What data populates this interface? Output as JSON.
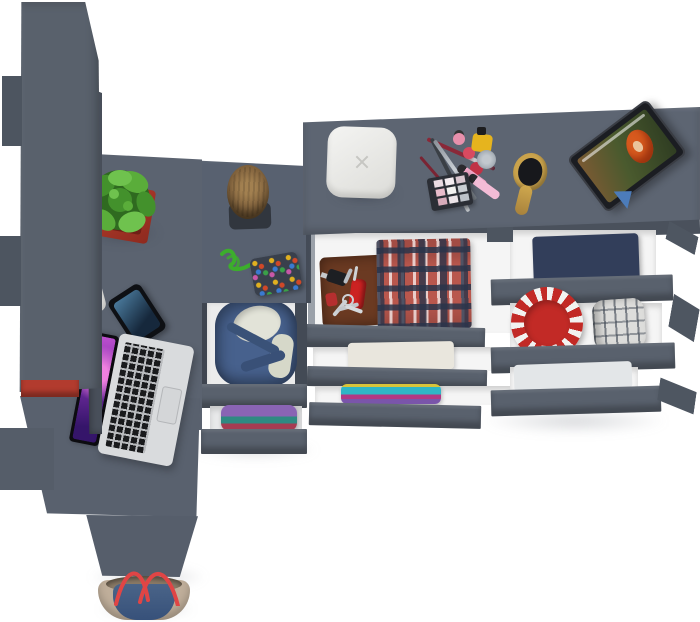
{
  "meta": {
    "description": "Top-down 3D product render of a dark-gray teen room furniture set: tall wardrobe on the left, corner desk with laptop, smartphone and potted plant, wooden log stool, and a wide chest of drawers with three columns of open drawers containing folded clothes; cosmetics, hairbrush, white music box and a tablet on top; denim tote bag at the bottom bench.",
    "background": "#ffffff"
  },
  "palette": {
    "furniture_top": "#5d6572",
    "furniture_front": "#59616d",
    "furniture_side": "#4b525d",
    "underside": "#4a515c",
    "drawer_interior": "#f5f5f5",
    "drawer_wall": "#9ba1a9",
    "accent_red": "#b23b2e"
  },
  "wardrobe": {
    "label": "tall wardrobe cabinet",
    "body": "#59616c",
    "wing": "#4d5560",
    "side_strip": "#49505b",
    "red_accent_box": "#b23b2e",
    "red_sliver": "#a02e20"
  },
  "desk": {
    "label": "corner desk",
    "surface": "#5b6370",
    "return_surface": "#586170",
    "lower_panel": "#59616e",
    "leg_block": "#555d69",
    "bench": "#565e6b"
  },
  "plant": {
    "label": "succulent in red pot",
    "pot": "#a83428",
    "pot_inner": "#6e1f16",
    "leaves": [
      "#2f6a20",
      "#43912c",
      "#5aad3a",
      "#6fc24e"
    ]
  },
  "stool": {
    "label": "wooden log stool on mat",
    "wood": "#8a6a42",
    "mat": "#31363e"
  },
  "laptop": {
    "label": "open silver laptop with nebula wallpaper",
    "body": "#d9dbdd",
    "keys": "#1a1b1d",
    "trackpad": "#d4d6d8",
    "screen_gradient": [
      "#c050d0",
      "#7a30a8",
      "#35156a"
    ]
  },
  "phone": {
    "label": "smartphone",
    "body": "#0e1014",
    "screen_top": "#4a7a9c",
    "screen_bottom": "#16283c"
  },
  "earbud_clip": {
    "label": "small white clip/earbud on desk edge",
    "color": "#f2f2f0"
  },
  "keychain": {
    "label": "beaded keychain with green cord",
    "cord": "#3cae2c",
    "patch": "#39404c",
    "beads": [
      "#e0b020",
      "#d04828",
      "#3a7ad0",
      "#3aa048",
      "#c858a8"
    ]
  },
  "dresser": {
    "label": "wide chest of drawers, drawers pulled open",
    "top": "#5d6572",
    "front": "#59616d",
    "underside": "#4a515c",
    "divider": "#4d5560",
    "side_wedge": "#4e5661"
  },
  "top_items": {
    "white_box": {
      "label": "white rounded music/jewelry box with x-mark",
      "color": "#ececea",
      "mark": "#c6c6c2"
    },
    "makeup": {
      "label": "cosmetics cluster",
      "pencils": [
        "#a03545",
        "#3a3f45",
        "#9aa0a8",
        "#7a2433"
      ],
      "nail_polish": [
        "#e890ac",
        "#d84a60",
        "#c03246"
      ],
      "yellow_bottle": "#e6b41e",
      "silver_jar": "#aab2ba",
      "lip_gloss": [
        "#f0a6c6",
        "#f3bcd6"
      ],
      "palette_case": "#2b2e35",
      "palette_pans": [
        "#eadbe2",
        "#f4ecf0",
        "#d9c6cf",
        "#e9bccb",
        "#f2f1ef",
        "#c9cdd2",
        "#d7abba",
        "#ece4e8",
        "#bcc1c8"
      ]
    },
    "hairbrush": {
      "label": "wooden oval hairbrush",
      "handle": "#caa34c",
      "bristles": "#17181c"
    },
    "tablet": {
      "label": "tablet on stand playing a movie (red-haired character)",
      "frame": "#1b1d22",
      "screen": [
        "#7b5a33",
        "#4a5a2e",
        "#2f3d22"
      ],
      "hair": "#d85a1e",
      "stand": "#4c7cba"
    }
  },
  "drawers": {
    "middle_chest": {
      "drawer1": {
        "label": "blue hoodie with cream lining",
        "hoodie": "#47618d",
        "lining": "#e2e3d8"
      },
      "drawer2": {
        "label": "folded stack purple/teal/crimson",
        "colors": [
          "#8a64b4",
          "#2f8a82",
          "#a63c52"
        ]
      }
    },
    "left_column": {
      "drawer1": {
        "label": "leather wallet with car key, red pocket knife, keys + folded red plaid shirt",
        "wallet": "#6b3a22",
        "knife": "#cc2222",
        "key_fob": "#b52f2f",
        "plaid": [
          "#b9574d",
          "#2a344a",
          "#ffffff"
        ]
      },
      "drawer2": {
        "label": "folded cream towel",
        "towel": "#e9e6dd"
      },
      "drawer3": {
        "label": "bright folded t-shirts",
        "colors": [
          "#d8c43a",
          "#2fb6c6",
          "#b23884",
          "#7a55aa"
        ]
      }
    },
    "right_column": {
      "drawer1": {
        "label": "folded dark jeans with orange stitching",
        "denim": "#323e5a",
        "stitch": "#cd8c3c"
      },
      "drawer2": {
        "label": "red disc with white rim pattern + rolled gray plaid shirt",
        "disc": "#c22a26",
        "disc_marks": "#f2f2f0",
        "roll": "#dddddb"
      },
      "drawer3": {
        "label": "pale folded shirt",
        "color": "#e3e6e8"
      }
    }
  },
  "bag": {
    "label": "denim tote bag with red straps",
    "denim": "#44608a",
    "trim": "#bfae9a",
    "interior": "#8a7a66",
    "straps": "#e04545"
  }
}
